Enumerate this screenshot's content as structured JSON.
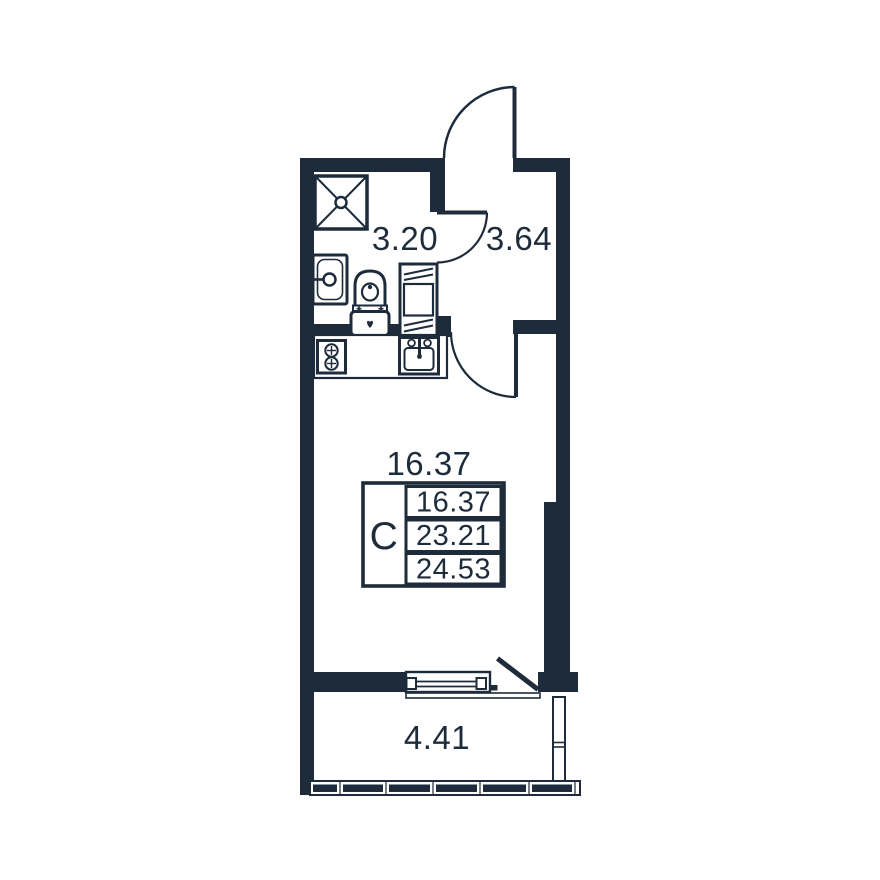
{
  "floor_plan": {
    "background_color": "#ffffff",
    "wall_color": "#1d2b3b",
    "rooms": {
      "bathroom": {
        "area": "3.20"
      },
      "hallway": {
        "area": "3.64"
      },
      "living_room": {
        "area": "16.37"
      },
      "balcony": {
        "area": "4.41"
      }
    },
    "info_table": {
      "type_label": "С",
      "rows": [
        "16.37",
        "23.21",
        "24.53"
      ]
    },
    "fixture_icons": [
      "shower-icon",
      "bathroom-sink-icon",
      "toilet-icon",
      "washing-machine-icon",
      "stove-icon",
      "kitchen-sink-icon"
    ],
    "door_icons": [
      "entrance-door-icon",
      "bathroom-door-icon",
      "living-room-door-icon",
      "balcony-door-icon"
    ],
    "window_icons": [
      "living-room-window-icon",
      "balcony-glazing-icon"
    ]
  }
}
